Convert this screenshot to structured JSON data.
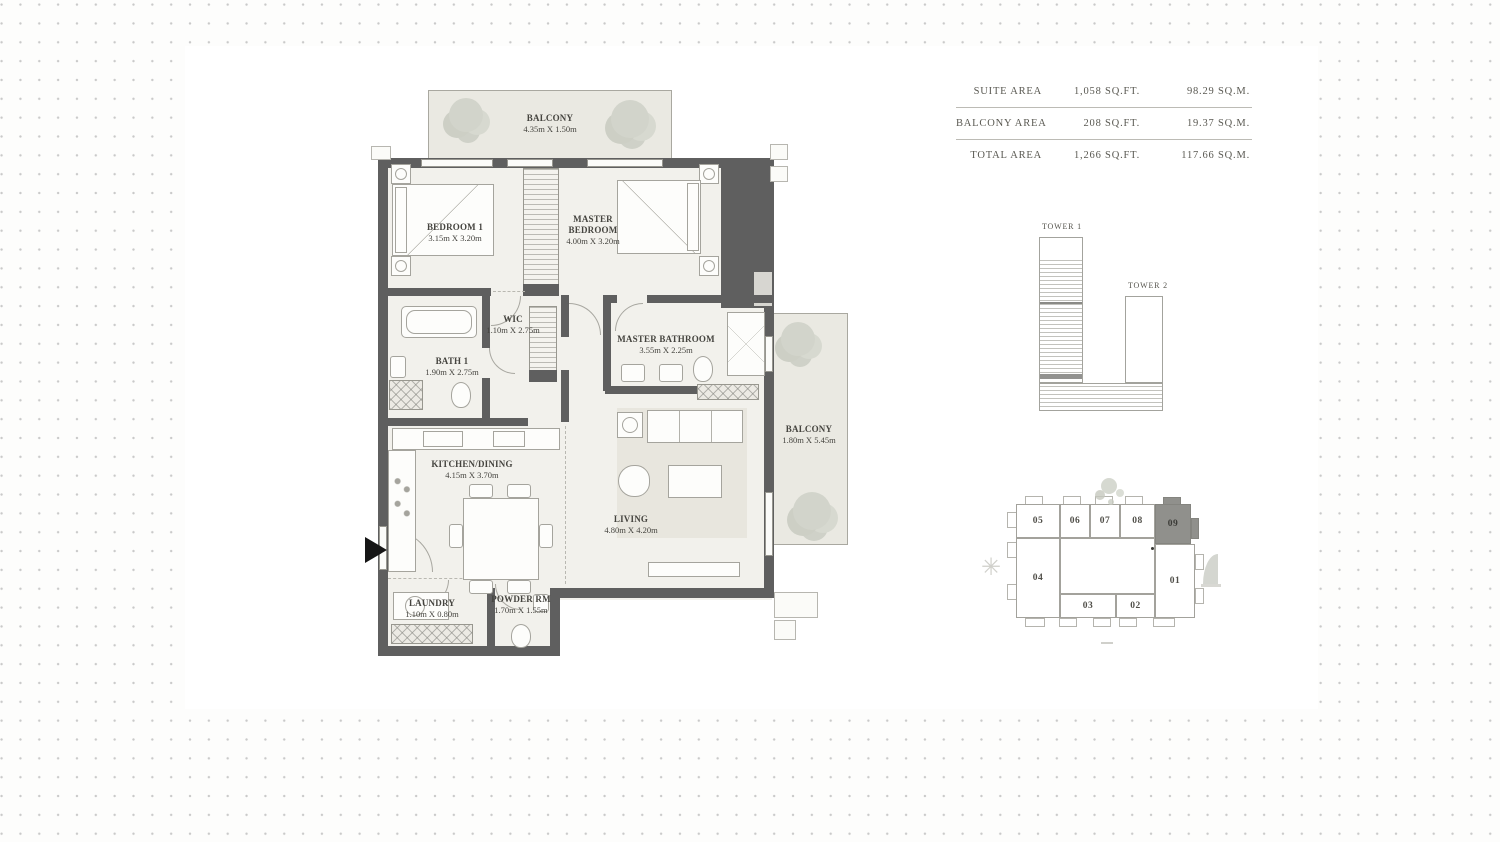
{
  "area_table": {
    "rows": [
      {
        "label": "SUITE AREA",
        "sqft": "1,058 SQ.FT.",
        "sqm": "98.29 SQ.M."
      },
      {
        "label": "BALCONY AREA",
        "sqft": "208 SQ.FT.",
        "sqm": "19.37 SQ.M."
      },
      {
        "label": "TOTAL AREA",
        "sqft": "1,266 SQ.FT.",
        "sqm": "117.66 SQ.M."
      }
    ]
  },
  "floorplan": {
    "balcony_top": {
      "name": "BALCONY",
      "dims": "4.35m X 1.50m"
    },
    "bedroom1": {
      "name": "BEDROOM 1",
      "dims": "3.15m X 3.20m"
    },
    "master_bedroom": {
      "name": "MASTER BEDROOM",
      "dims": "4.00m X 3.20m"
    },
    "wic": {
      "name": "WIC",
      "dims": "1.10m X 2.75m"
    },
    "bath1": {
      "name": "BATH 1",
      "dims": "1.90m X 2.75m"
    },
    "master_bathroom": {
      "name": "MASTER BATHROOM",
      "dims": "3.55m X 2.25m"
    },
    "kitchen_dining": {
      "name": "KITCHEN/DINING",
      "dims": "4.15m X 3.70m"
    },
    "living": {
      "name": "LIVING",
      "dims": "4.80m X 4.20m"
    },
    "balcony_right": {
      "name": "BALCONY",
      "dims": "1.80m X 5.45m"
    },
    "laundry": {
      "name": "LAUNDRY",
      "dims": "1.10m X 0.80m"
    },
    "powder": {
      "name": "POWDER RM",
      "dims": "1.70m X 1.55m"
    }
  },
  "towers": {
    "tower1": "TOWER 1",
    "tower2": "TOWER 2"
  },
  "keyplan": {
    "units": [
      "05",
      "06",
      "07",
      "08",
      "09",
      "01",
      "02",
      "03",
      "04"
    ],
    "highlighted_unit": "09"
  },
  "colors": {
    "wall": "#5f5f5f",
    "highlight_unit": "#90908c",
    "text": "#55544d",
    "dot": "#c9c9c9"
  }
}
